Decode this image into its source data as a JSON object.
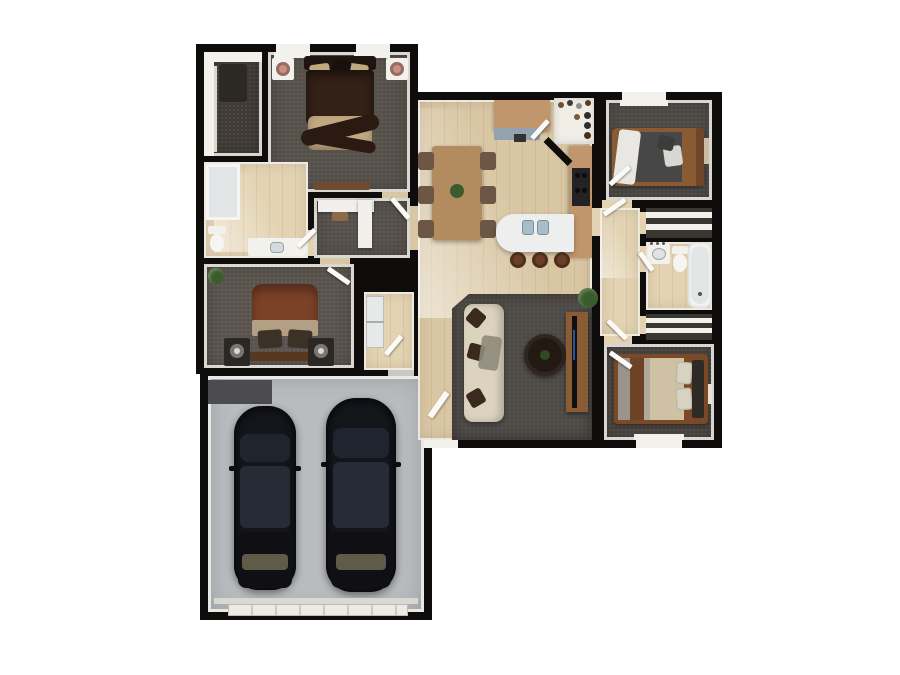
{
  "palette": {
    "wall": "#0e0d0b",
    "trim": "#f3f1ec",
    "door": "#fbfaf7",
    "wood": "#d9c6a3",
    "wood_light": "#e3d3b2",
    "carpet": "#55504a",
    "carpet2": "#5a534d",
    "carpet3": "#4d4a46",
    "carpet4": "#4b4641",
    "rug": "#4e4a46",
    "closet_floor": "#403b36",
    "garage_floor": "#b9bcbe",
    "garage_mat": "#4c4c50",
    "garage_door": "#eceae3",
    "car": "#15161b",
    "car_glass": "#262b36",
    "car_glass2": "#20242e",
    "windshield": "#6d6852",
    "sofa": "#dcd3bf",
    "pillow": "#3a2a1d",
    "throw": "#8f897b",
    "coffee": "#221913",
    "console": "#8a5c36",
    "tv": "#101012",
    "dining": "#b28c5e",
    "chair": "#6c5746",
    "counter": "#c2966c",
    "counter_top": "#93a2ae",
    "island": "#edefee",
    "sink": "#a9bdc9",
    "stool": "#693f27",
    "appliance": "#e7e9e8",
    "plant": "#3a5c2d",
    "lamp": "#c98f82",
    "lamp2": "#ddd8ce",
    "fixture": "#f5f5f3",
    "fixture_in": "#e2e5e5",
    "bedm_dark": "#332017",
    "bedm_head": "#1f1410",
    "bedm_sash": "#2a1a12",
    "tan": "#c0a87f",
    "rust": "#7c4227",
    "rust_tan": "#b3a084",
    "night": "#2a2724",
    "bed_foot": "#57381f",
    "bed3_frame": "#8a5a33",
    "bed3_gray": "#474747",
    "bed4_frame": "#7a4a28",
    "bed4_tan": "#cfc2a4",
    "bed4_brown": "#6e4325",
    "bed4_gray": "#9a948c",
    "shelf_back": "#3a3631",
    "stove": "#232326",
    "art": "#cdbca4",
    "desk": "#f0efec"
  },
  "scene": {
    "type": "floor-plan-3d-top-view",
    "background": "#ffffff",
    "rooms": [
      {
        "name": "walk-in-closet"
      },
      {
        "name": "master-bedroom",
        "beds": 1,
        "nightstands": 2,
        "windows": 2
      },
      {
        "name": "master-bathroom",
        "fixtures": [
          "shower",
          "toilet",
          "vanity"
        ]
      },
      {
        "name": "desk-nook"
      },
      {
        "name": "bedroom-2",
        "beds": 1,
        "nightstands": 2
      },
      {
        "name": "garage",
        "cars": 2
      },
      {
        "name": "laundry"
      },
      {
        "name": "dining-area",
        "chairs": 6
      },
      {
        "name": "kitchen",
        "stools": 3,
        "fixtures": [
          "island-sink",
          "stove",
          "pantry"
        ]
      },
      {
        "name": "living-room",
        "furniture": [
          "sofa",
          "coffee-table",
          "tv-console",
          "plant"
        ]
      },
      {
        "name": "bedroom-3",
        "beds": 1,
        "windows": 1
      },
      {
        "name": "hallway"
      },
      {
        "name": "bathroom-2",
        "fixtures": [
          "vanity",
          "toilet",
          "bathtub"
        ]
      },
      {
        "name": "linen-closet-top"
      },
      {
        "name": "linen-closet-bottom"
      },
      {
        "name": "bedroom-4",
        "beds": 1,
        "windows": 1
      }
    ]
  }
}
